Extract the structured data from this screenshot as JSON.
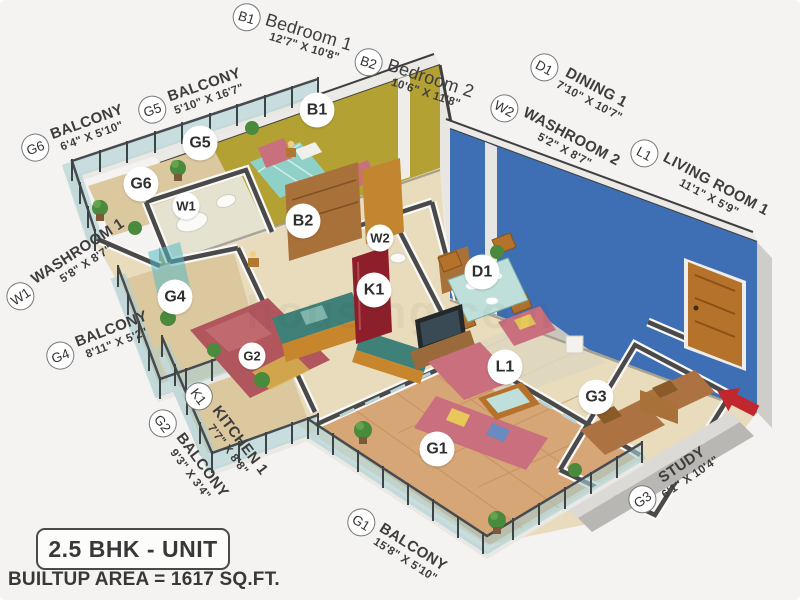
{
  "plan": {
    "type_label": "2.5 BHK - UNIT",
    "area_label": "BUILTUP AREA = 1617 SQ.FT.",
    "watermark": "housing.com"
  },
  "rooms": [
    {
      "code": "B1",
      "name": "Bedroom 1",
      "dims": "12'7\" X 10'8\""
    },
    {
      "code": "B2",
      "name": "Bedroom 2",
      "dims": "10'6\" X 11'8\""
    },
    {
      "code": "D1",
      "name": "DINING 1",
      "dims": "7'10\" X 10'7\""
    },
    {
      "code": "W2",
      "name": "WASHROOM 2",
      "dims": "5'2\" X 8'7\""
    },
    {
      "code": "L1",
      "name": "LIVING ROOM 1",
      "dims": "11'1\" X 5'9\""
    },
    {
      "code": "G6",
      "name": "BALCONY",
      "dims": "6'4\" X 5'10\""
    },
    {
      "code": "G5",
      "name": "BALCONY",
      "dims": "5'10\" X 16'7\""
    },
    {
      "code": "W1",
      "name": "WASHROOM 1",
      "dims": "5'8\" X 8'7\""
    },
    {
      "code": "G4",
      "name": "BALCONY",
      "dims": "8'11\" X 5'2\""
    },
    {
      "code": "K1",
      "name": "KITCHEN 1",
      "dims": "7'7\" X 8'8\""
    },
    {
      "code": "G2",
      "name": "BALCONY",
      "dims": "9'3\" X 3'4\""
    },
    {
      "code": "G1",
      "name": "BALCONY",
      "dims": "15'8\" X 5'10\""
    },
    {
      "code": "G3",
      "name": "STUDY",
      "dims": "6'1\" X 10'4\""
    }
  ],
  "colors": {
    "bedroom_wall": "#b3a134",
    "living_wall": "#3e6eb4",
    "wall_cap": "#4a4a4a",
    "floor": "#e9dcbd",
    "balcony_tile": "#d7a676",
    "glass": "#a9ced2",
    "door_wood": "#b5722a",
    "entry_arrow": "#c1272d"
  }
}
